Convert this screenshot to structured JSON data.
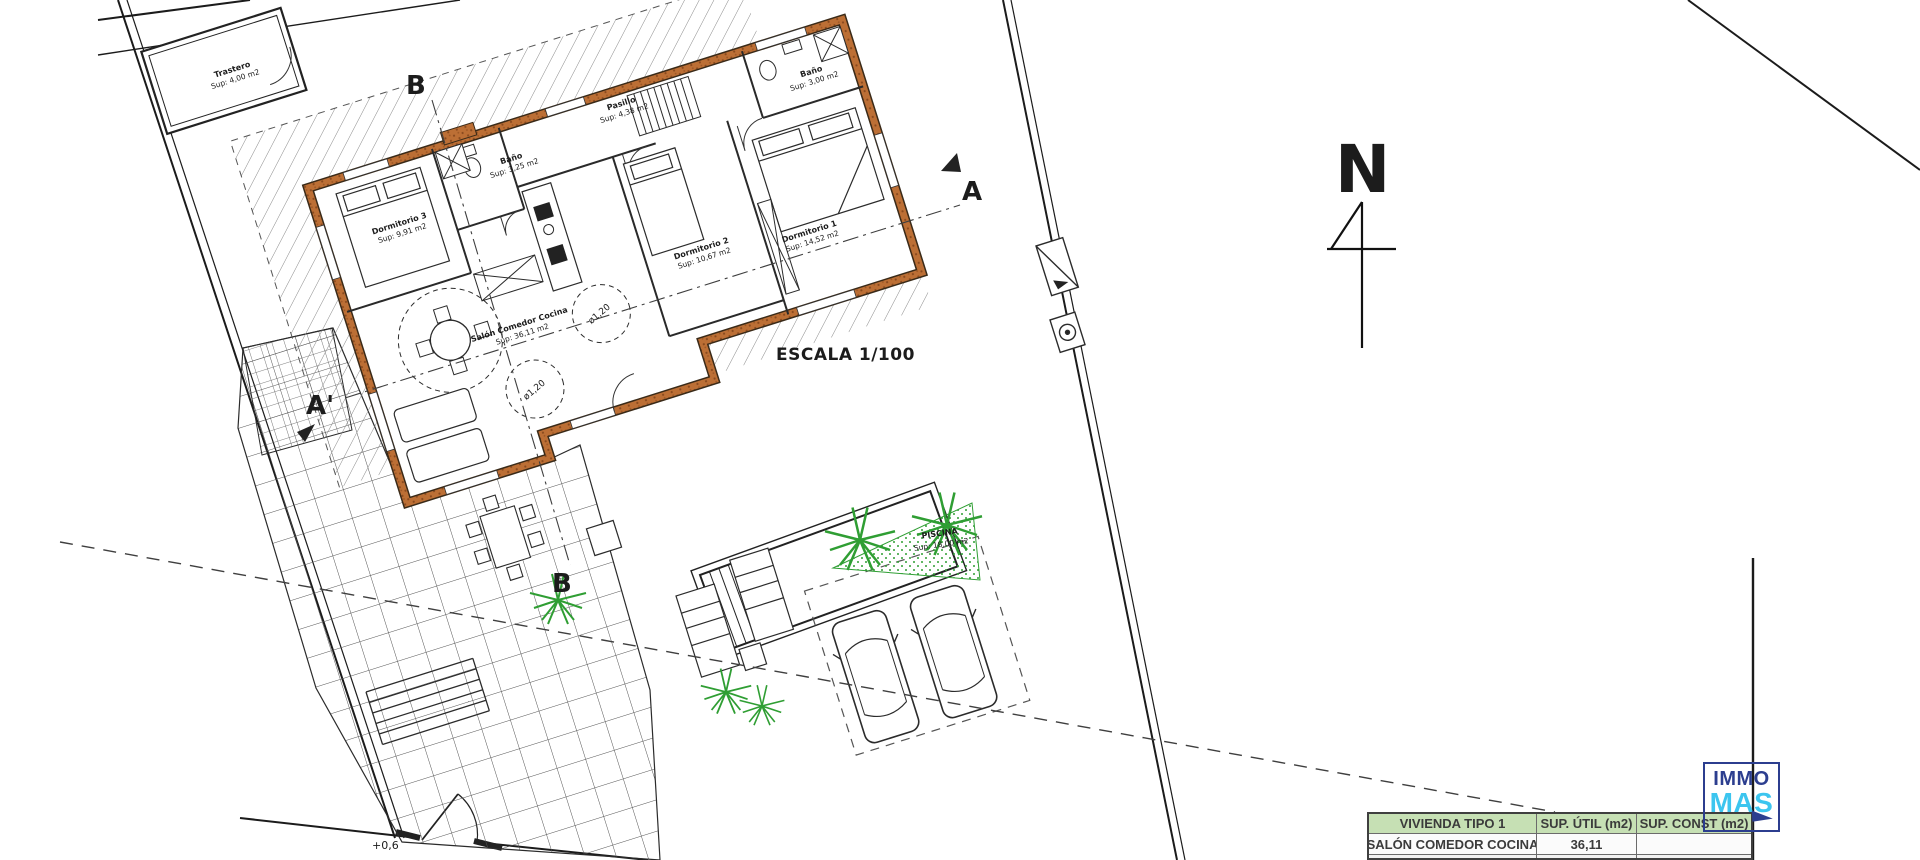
{
  "plan": {
    "north_label": "N",
    "scale_label": "ESCALA 1/100",
    "level_label": "+0,6",
    "markers": {
      "b_top": "B",
      "a_right": "A",
      "a_prime": "A'",
      "b_bottom": "B"
    },
    "rooms": [
      {
        "name": "Trastero",
        "sup": "Sup: 4,00 m2"
      },
      {
        "name": "Dormitorio 3",
        "sup": "Sup: 9,91 m2"
      },
      {
        "name": "Baño",
        "sup": "Sup: 3,25 m2"
      },
      {
        "name": "Pasillo",
        "sup": "Sup: 4,38 m2"
      },
      {
        "name": "Baño",
        "sup": "Sup: 3,00 m2"
      },
      {
        "name": "Dormitorio 2",
        "sup": "Sup: 10,67 m2"
      },
      {
        "name": "Dormitorio 1",
        "sup": "Sup: 14,52 m2"
      },
      {
        "name": "Salón Comedor Cocina",
        "sup": "Sup: 36,11 m2"
      },
      {
        "name": "PISCINA",
        "sup": "Sup: 18,00 m2"
      }
    ],
    "circle_label_1": "ø1,20",
    "circle_label_2": "ø1,20",
    "colors": {
      "wall": "#bc6f35",
      "plant_green": "#2f9e33"
    }
  },
  "table": {
    "headers": [
      "VIVIENDA TIPO 1",
      "SUP. ÚTIL (m2)",
      "SUP. CONST (m2)"
    ],
    "rows": [
      [
        "SALÓN COMEDOR COCINA",
        "36,11",
        ""
      ]
    ]
  },
  "logo": {
    "line1": "IMMO",
    "line2": "MAS",
    "navy": "#2c3e8f",
    "cyan": "#3cc5ef"
  }
}
